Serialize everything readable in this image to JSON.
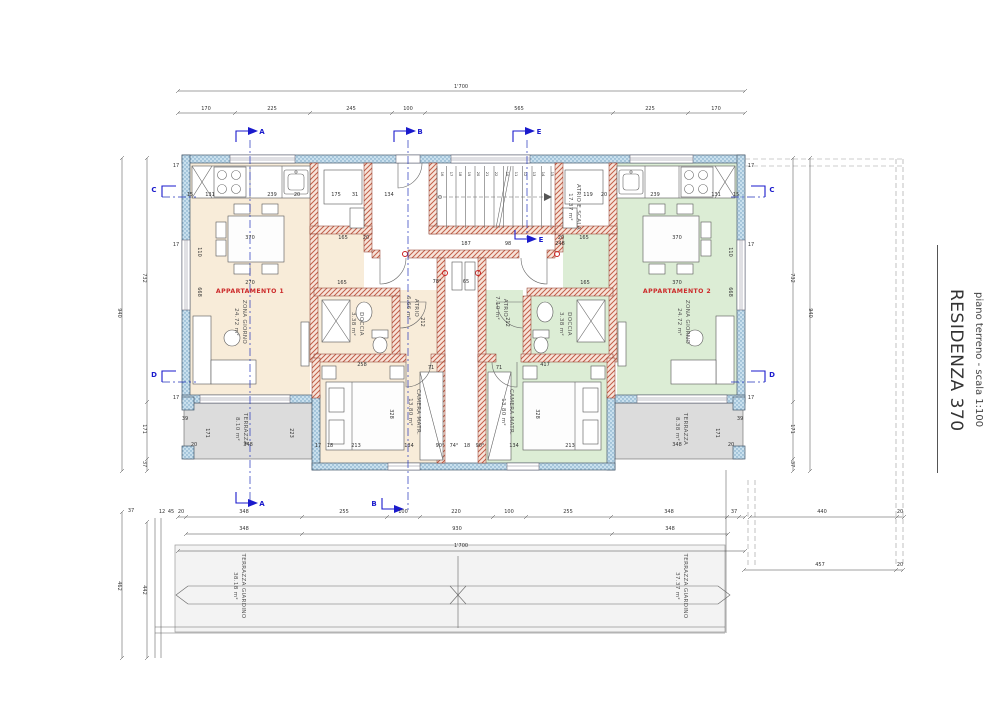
{
  "title_block": {
    "project": "RESIDENZA 370",
    "sheet": "piano terreno - scala 1:100"
  },
  "rooms": {
    "apt1": {
      "name": "APPARTAMENTO 1",
      "living": "ZONA GIORNO",
      "living_area": "24.72 m²",
      "atrio": "ATRIO",
      "atrio_area": "6.66 m²",
      "bath": "DOCCIA",
      "bath_area": "3.38 m²",
      "bedroom": "CAMERA MATR.",
      "bedroom_area": "13.80 m²",
      "terrace": "TERRAZZA",
      "terrace_area": "8.10 m²",
      "garden": "TERRAZZA GIARDINO",
      "garden_area": "38.18 m²"
    },
    "apt2": {
      "name": "APPARTAMENTO 2",
      "living": "ZONA GIORNO",
      "living_area": "24.72 m²",
      "atrio": "ATRIO",
      "atrio_area": "7.10 m²",
      "bath": "DOCCIA",
      "bath_area": "3.38 m²",
      "bedroom": "CAMERA MATR.",
      "bedroom_area": "13.80 m²",
      "terrace": "TERRAZZA",
      "terrace_area": "8.38 m²",
      "garden": "TERRAZZA GIARDINO",
      "garden_area": "37.37 m²"
    },
    "core": {
      "name": "ATRIO E SCALA",
      "area": "17.37 m²"
    }
  },
  "sections": {
    "a": "A",
    "b": "B",
    "c": "C",
    "d": "D",
    "e": "E"
  },
  "colors": {
    "apt1_fill": "#f8ecd9",
    "apt2_fill": "#dcedd5",
    "terrace_fill": "#dcdcdc",
    "wall_exterior": "#c9e0ee",
    "wall_interior_hatch": "#c2604a",
    "marker_blue": "#1a1acc",
    "label_red": "#cc2a2a"
  },
  "dimensions": {
    "labels": [
      {
        "t": "1'700",
        "x": 461,
        "y": 88
      },
      {
        "t": "170",
        "x": 206,
        "y": 110
      },
      {
        "t": "225",
        "x": 272,
        "y": 110
      },
      {
        "t": "245",
        "x": 351,
        "y": 110
      },
      {
        "t": "100",
        "x": 408,
        "y": 110
      },
      {
        "t": "565",
        "x": 519,
        "y": 110
      },
      {
        "t": "225",
        "x": 650,
        "y": 110
      },
      {
        "t": "170",
        "x": 716,
        "y": 110
      },
      {
        "t": "940",
        "x": 118,
        "y": 313,
        "r": 90
      },
      {
        "t": "732",
        "x": 143,
        "y": 278,
        "r": 90
      },
      {
        "t": "171",
        "x": 143,
        "y": 429,
        "r": 90
      },
      {
        "t": "37",
        "x": 143,
        "y": 464,
        "r": 90
      },
      {
        "t": "462",
        "x": 118,
        "y": 586,
        "r": 90
      },
      {
        "t": "442",
        "x": 143,
        "y": 590,
        "r": 90
      },
      {
        "t": "37",
        "x": 131,
        "y": 512
      },
      {
        "t": "732",
        "x": 791,
        "y": 278,
        "r": 90
      },
      {
        "t": "171",
        "x": 791,
        "y": 429,
        "r": 90
      },
      {
        "t": "37",
        "x": 791,
        "y": 464,
        "r": 90
      },
      {
        "t": "940",
        "x": 809,
        "y": 313,
        "r": 90
      },
      {
        "t": "12",
        "x": 162,
        "y": 513
      },
      {
        "t": "45",
        "x": 171,
        "y": 513
      },
      {
        "t": "20",
        "x": 181,
        "y": 513
      },
      {
        "t": "348",
        "x": 244,
        "y": 513
      },
      {
        "t": "255",
        "x": 344,
        "y": 513
      },
      {
        "t": "100",
        "x": 403,
        "y": 513
      },
      {
        "t": "220",
        "x": 456,
        "y": 513
      },
      {
        "t": "100",
        "x": 509,
        "y": 513
      },
      {
        "t": "255",
        "x": 568,
        "y": 513
      },
      {
        "t": "348",
        "x": 669,
        "y": 513
      },
      {
        "t": "37",
        "x": 734,
        "y": 513
      },
      {
        "t": "348",
        "x": 244,
        "y": 530
      },
      {
        "t": "930",
        "x": 457,
        "y": 530
      },
      {
        "t": "348",
        "x": 670,
        "y": 530
      },
      {
        "t": "1'700",
        "x": 461,
        "y": 547
      },
      {
        "t": "440",
        "x": 822,
        "y": 513
      },
      {
        "t": "20",
        "x": 900,
        "y": 513
      },
      {
        "t": "457",
        "x": 820,
        "y": 566
      },
      {
        "t": "20",
        "x": 900,
        "y": 566
      },
      {
        "t": "15",
        "x": 190,
        "y": 196
      },
      {
        "t": "131",
        "x": 210,
        "y": 196
      },
      {
        "t": "239",
        "x": 272,
        "y": 196
      },
      {
        "t": "20",
        "x": 297,
        "y": 196
      },
      {
        "t": "175",
        "x": 336,
        "y": 196
      },
      {
        "t": "31",
        "x": 355,
        "y": 196
      },
      {
        "t": "134",
        "x": 389,
        "y": 196
      },
      {
        "t": "119",
        "x": 588,
        "y": 196
      },
      {
        "t": "20",
        "x": 604,
        "y": 196
      },
      {
        "t": "239",
        "x": 655,
        "y": 196
      },
      {
        "t": "131",
        "x": 716,
        "y": 196
      },
      {
        "t": "15",
        "x": 736,
        "y": 196
      },
      {
        "t": "370",
        "x": 250,
        "y": 239
      },
      {
        "t": "165",
        "x": 343,
        "y": 239
      },
      {
        "t": "20",
        "x": 366,
        "y": 239
      },
      {
        "t": "20",
        "x": 561,
        "y": 239
      },
      {
        "t": "165",
        "x": 584,
        "y": 239
      },
      {
        "t": "370",
        "x": 677,
        "y": 239
      },
      {
        "t": "187",
        "x": 466,
        "y": 245
      },
      {
        "t": "98",
        "x": 508,
        "y": 245
      },
      {
        "t": "248",
        "x": 560,
        "y": 245
      },
      {
        "t": "270",
        "x": 250,
        "y": 284
      },
      {
        "t": "165",
        "x": 342,
        "y": 284
      },
      {
        "t": "165",
        "x": 585,
        "y": 284
      },
      {
        "t": "370",
        "x": 677,
        "y": 284
      },
      {
        "t": "110",
        "x": 198,
        "y": 252,
        "r": 90
      },
      {
        "t": "668",
        "x": 198,
        "y": 292,
        "r": 90
      },
      {
        "t": "110",
        "x": 729,
        "y": 252,
        "r": 90
      },
      {
        "t": "668",
        "x": 729,
        "y": 292,
        "r": 90
      },
      {
        "t": "78°",
        "x": 437,
        "y": 283
      },
      {
        "t": "65",
        "x": 466,
        "y": 283
      },
      {
        "t": "212",
        "x": 421,
        "y": 322,
        "r": 90
      },
      {
        "t": "212",
        "x": 506,
        "y": 322,
        "r": 90
      },
      {
        "t": "71",
        "x": 431,
        "y": 369
      },
      {
        "t": "71",
        "x": 499,
        "y": 369
      },
      {
        "t": "258",
        "x": 362,
        "y": 366
      },
      {
        "t": "417",
        "x": 545,
        "y": 366
      },
      {
        "t": "17",
        "x": 318,
        "y": 447
      },
      {
        "t": "18",
        "x": 330,
        "y": 447
      },
      {
        "t": "213",
        "x": 356,
        "y": 447
      },
      {
        "t": "134",
        "x": 409,
        "y": 447
      },
      {
        "t": "90°",
        "x": 440,
        "y": 447
      },
      {
        "t": "74°",
        "x": 454,
        "y": 447
      },
      {
        "t": "18",
        "x": 467,
        "y": 447
      },
      {
        "t": "90°",
        "x": 480,
        "y": 447
      },
      {
        "t": "134",
        "x": 514,
        "y": 447
      },
      {
        "t": "213",
        "x": 570,
        "y": 447
      },
      {
        "t": "328",
        "x": 390,
        "y": 414,
        "r": 90
      },
      {
        "t": "328",
        "x": 536,
        "y": 414,
        "r": 90
      },
      {
        "t": "39",
        "x": 185,
        "y": 420
      },
      {
        "t": "348",
        "x": 248,
        "y": 446
      },
      {
        "t": "171",
        "x": 206,
        "y": 433,
        "r": 90
      },
      {
        "t": "223",
        "x": 290,
        "y": 433,
        "r": 90
      },
      {
        "t": "20",
        "x": 194,
        "y": 446
      },
      {
        "t": "348",
        "x": 677,
        "y": 446
      },
      {
        "t": "171",
        "x": 716,
        "y": 433,
        "r": 90
      },
      {
        "t": "20",
        "x": 731,
        "y": 446
      },
      {
        "t": "39",
        "x": 740,
        "y": 420
      },
      {
        "t": "17",
        "x": 176,
        "y": 167
      },
      {
        "t": "17",
        "x": 176,
        "y": 246
      },
      {
        "t": "17",
        "x": 176,
        "y": 399
      },
      {
        "t": "17",
        "x": 751,
        "y": 167
      },
      {
        "t": "17",
        "x": 751,
        "y": 246
      },
      {
        "t": "17",
        "x": 751,
        "y": 399
      }
    ],
    "treads": [
      {
        "t": "16",
        "x": 441
      },
      {
        "t": "17",
        "x": 450
      },
      {
        "t": "18",
        "x": 459
      },
      {
        "t": "19",
        "x": 468
      },
      {
        "t": "20",
        "x": 477
      },
      {
        "t": "21",
        "x": 486
      },
      {
        "t": "22",
        "x": 495
      },
      {
        "t": "10",
        "x": 506
      },
      {
        "t": "11",
        "x": 515
      },
      {
        "t": "12",
        "x": 524
      },
      {
        "t": "13",
        "x": 533
      },
      {
        "t": "14",
        "x": 542
      },
      {
        "t": "15",
        "x": 551
      }
    ]
  }
}
